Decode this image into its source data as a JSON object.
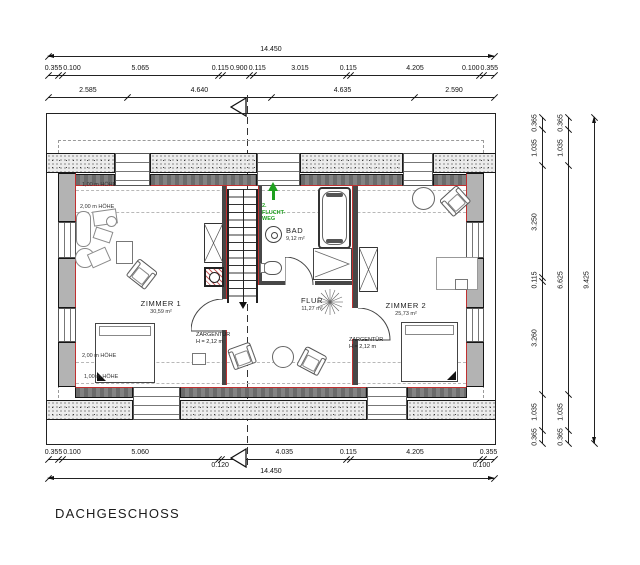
{
  "title": "DACHGESCHOSS",
  "plan": {
    "rooms": [
      {
        "name": "ZIMMER 1",
        "area": "30,59 m²"
      },
      {
        "name": "FLUR",
        "area": "11,27 m²"
      },
      {
        "name": "ZIMMER 2",
        "area": "25,73 m²"
      },
      {
        "name": "BAD",
        "area": "9,12 m²"
      }
    ],
    "door_label": {
      "line1": "ZARGENTÜR",
      "line2": "H = 2,12 m"
    },
    "height_labels": {
      "h1": "1,00 m HÖHE",
      "h2": "2,00 m HÖHE"
    },
    "escape_route": {
      "line1": "2.",
      "line2": "FLUCHT-",
      "line3": "WEG"
    },
    "colors": {
      "escape_green": "#1fa01f",
      "accent_red": "#c03030",
      "wall_gray": "#b3b3b3"
    }
  },
  "dimensions": {
    "top": [
      {
        "values": [
          "14.450"
        ]
      },
      {
        "values": [
          "0.355",
          "0.100",
          "5.065",
          "0.115",
          "0.900",
          "0.115",
          "3.015",
          "0.115",
          "4.205",
          "0.100",
          "0.355"
        ]
      },
      {
        "values": [
          "2.585",
          "4.640",
          "4.635",
          "2.590"
        ]
      }
    ],
    "bottom": [
      {
        "values": [
          "0.355",
          "0.100",
          "5.060",
          "0.120",
          "4.035",
          "0.115",
          "4.205",
          "0.100",
          "0.355"
        ]
      },
      {
        "values": [
          "14.450"
        ]
      }
    ],
    "right": [
      {
        "values": [
          "0.365",
          "1.035",
          "3.250",
          "0.115",
          "3.260",
          "1.035",
          "0.365"
        ]
      },
      {
        "values": [
          "0.365",
          "1.035",
          "6.625",
          "1.035",
          "0.365"
        ]
      },
      {
        "values": [
          "9.425"
        ]
      }
    ]
  }
}
